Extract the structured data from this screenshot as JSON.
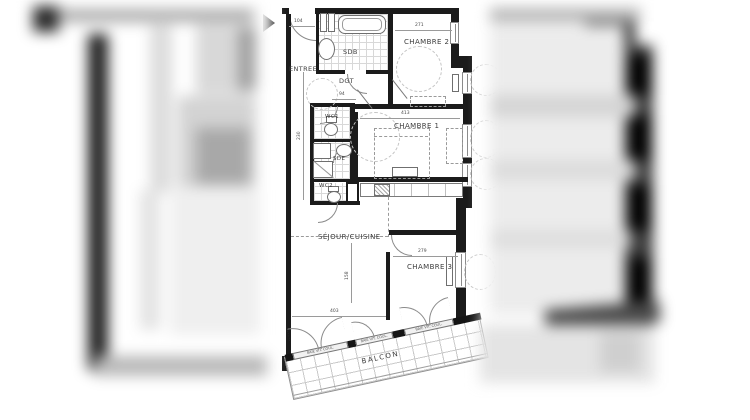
{
  "colors": {
    "wall": "#1b1b1b",
    "thin_line": "#9a9a9a",
    "tile_line": "#d8d8d8",
    "label_text": "#3c3c3c",
    "blur_dark": "#2a2a2a",
    "blur_gray": "#b5b5b5"
  },
  "rooms": {
    "entree": "ENTREE",
    "sdb": "SDB",
    "chambre2": "CHAMBRE 2",
    "dgt": "DGT",
    "wc1": "WC1",
    "chambre1": "CHAMBRE 1",
    "sde": "SDE",
    "wc2": "WC2",
    "sejour": "SÉJOUR/CUISINE",
    "chambre3": "CHAMBRE 3",
    "balcon": "BALCON"
  },
  "dims": {
    "d104": "104",
    "d271": "271",
    "d94": "94",
    "d230": "230",
    "d413": "413",
    "d158": "158",
    "d279": "279",
    "d403": "403"
  },
  "door_labels": {
    "b1": "BAIE VIT. COUL.",
    "b2": "BAIE VIT. COUL.",
    "b3": "BAIE VIT. COUL."
  }
}
